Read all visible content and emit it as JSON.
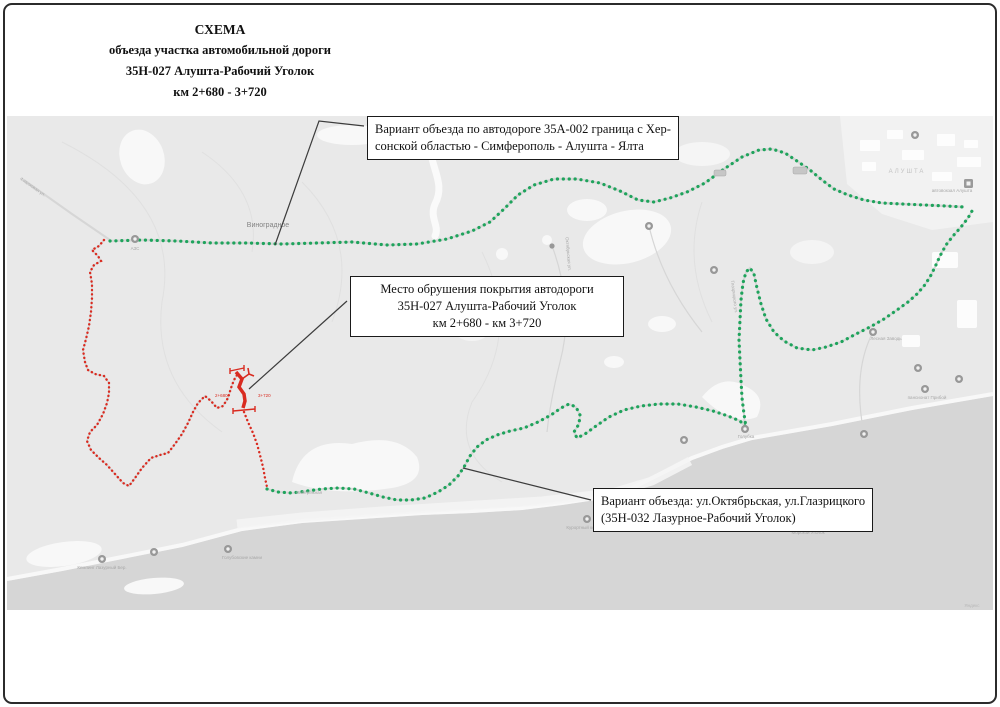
{
  "title": {
    "line1": "СХЕМА",
    "line2": "объезда участка автомобильной дороги",
    "line3": "35Н-027 Алушта-Рабочий Уголок",
    "line4": "км 2+680 - 3+720"
  },
  "callouts": {
    "detour_main": {
      "line1": "Вариант объезда по автодороге 35А-002 граница с Хер-",
      "line2": "сонской областью - Симферополь - Алушта - Ялта"
    },
    "collapse": {
      "line1": "Место обрушения покрытия автодороги",
      "line2": "35Н-027 Алушта-Рабочий Уголок",
      "line3": "км 2+680 - км 3+720"
    },
    "detour_local": {
      "line1": "Вариант объезда: ул.Октябрьская, ул.Глазрицкого",
      "line2": "(35Н-032 Лазурное-Рабочий Уголок)"
    }
  },
  "map": {
    "km_marks": {
      "start": "2+680",
      "end": "3+720"
    },
    "region_labels": {
      "vinogradnoe": "Виноградное",
      "alushta": "АЛУШТА",
      "azs": "АЗС",
      "bus_station": "автовокзал Алушта",
      "naberezhnaya": "Набережная",
      "glazritskogo": "Глазрицкого ул.",
      "oktyabrskaya": "Октябрьская ул.",
      "fialkovaya": "Фиалковая ул.",
      "golubka": "Голубка",
      "morskoy_ugolok": "Морской Уголок",
      "kurort": "Курортный комплекс",
      "golubovskie": "Голубовские камни",
      "kemping": "Кемпинг Лазурный Бер.",
      "lesnaya": "Лесная Заводь",
      "pansionat": "пансионат Прибой",
      "attribution": "Яндекс"
    },
    "colors": {
      "detour_route": "#1fa35c",
      "closed_route": "#d92b20",
      "land": "#e9e9e9",
      "sea": "#d6d6d6",
      "patch": "#f8f8f8",
      "leader_line": "#3c3c3c"
    }
  }
}
